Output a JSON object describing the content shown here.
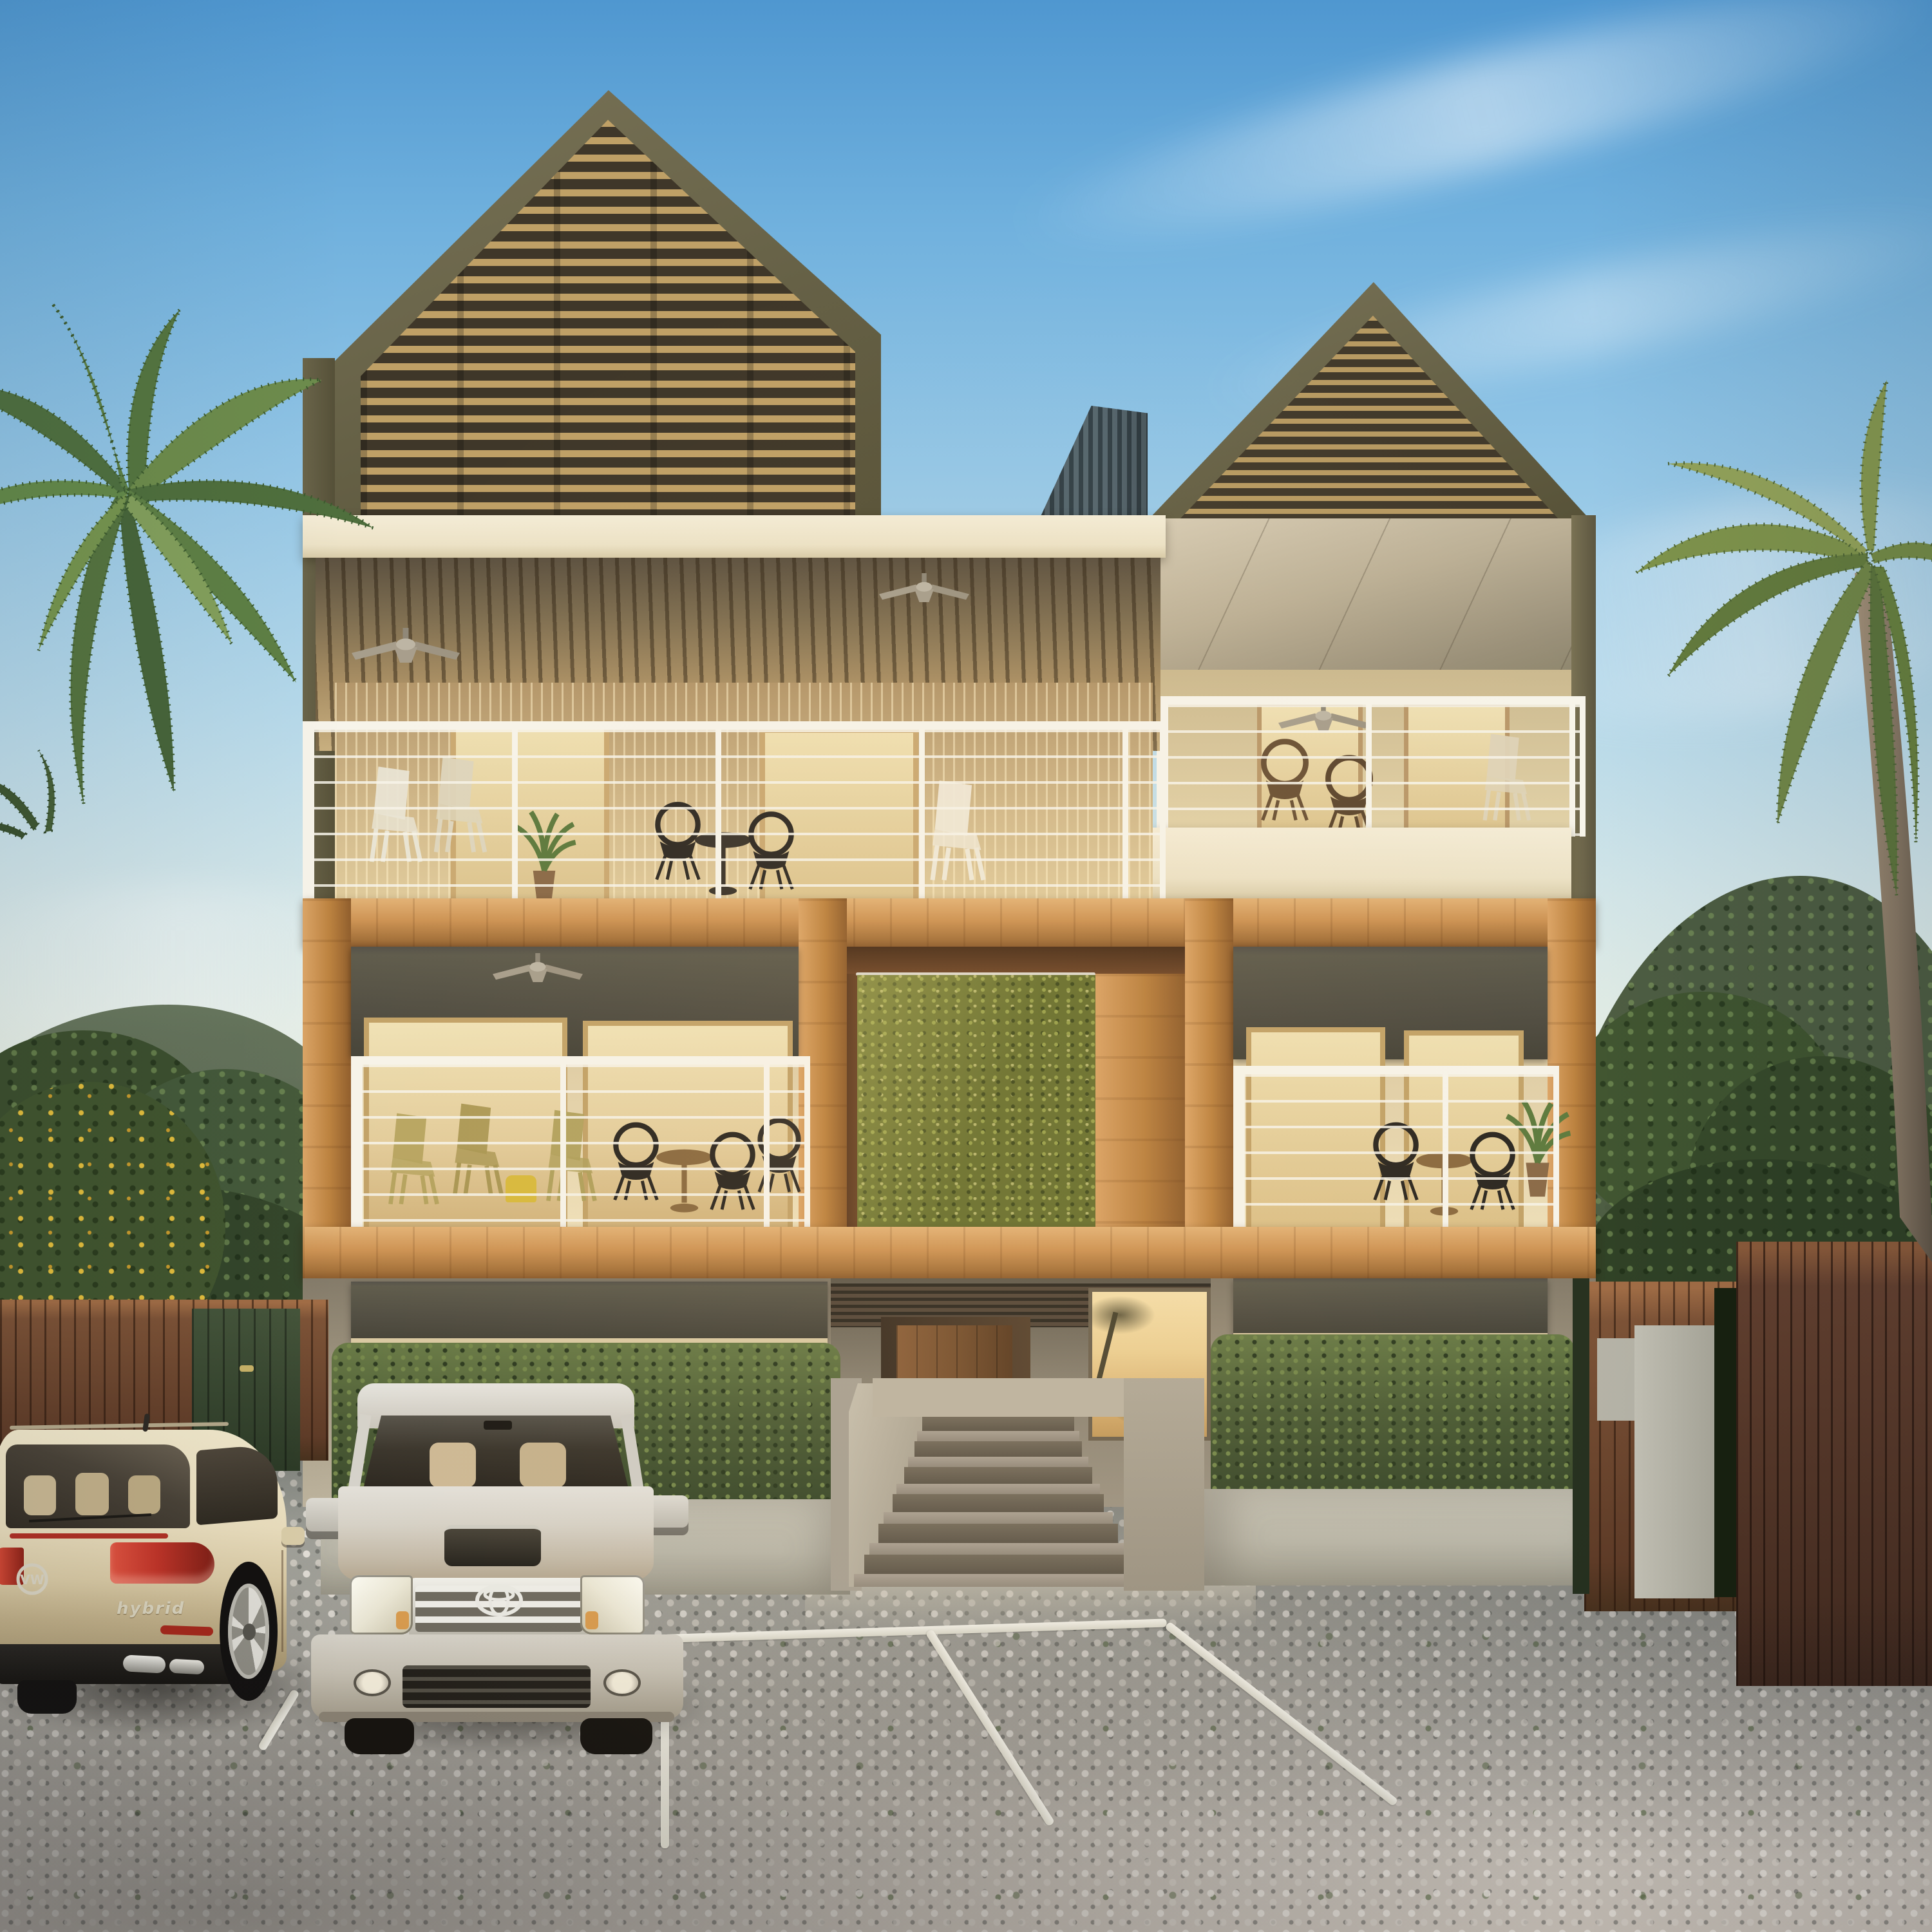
{
  "scene": {
    "description": "Photorealistic 3D architectural rendering of a modern tropical apartment building at dusk with louvered gable roofs, timber balconies, a living green wall, hedges, palm trees, forested hills and a paver parking lot with two parked vehicles",
    "time_of_day": "dusk"
  },
  "palette": {
    "sky_top": "#4f97d0",
    "sky_horizon": "#f1f2e6",
    "gable_frame": "#6a654a",
    "louver_light": "#bfa066",
    "louver_dark": "#3f3729",
    "corrugated_metal": "#44545c",
    "fascia_cream": "#f0e8d0",
    "soffit_wood": "#a98f64",
    "wall_cream": "#ddc9a0",
    "railing_white": "#f7f4ea",
    "timber": "#c08848",
    "awning_grey": "#54514a",
    "green_wall": "#67702f",
    "hedge_green": "#4e5e37",
    "ground_wall": "#a79d8a",
    "door_wood": "#75502f",
    "planter_grey": "#bdbaac",
    "pavement": "#adaca4",
    "parking_line": "#f1efe6",
    "fence_left": "#7c5236",
    "fence_right": "#63402f",
    "gate_green": "#36452f",
    "hill_green": "#4c5c42",
    "palm_green": "#6a8a4e",
    "palm_trunk": "#8d7c66",
    "vw_paint": "#e8dcba",
    "taillight_red": "#c0392b",
    "hilux_silver": "#d3d0c8",
    "glass_warm": "#ecd094",
    "shadow": "#3c3831"
  },
  "building": {
    "floors_visible": 3,
    "towers": [
      {
        "name": "left-louvered-gable",
        "shape": "pentagon",
        "louver_rows": 25
      },
      {
        "name": "right-louvered-gable",
        "shape": "triangle",
        "louver_rows": 14
      }
    ],
    "railing_cable_rows": 7,
    "balconies": [
      "third-floor-left",
      "third-floor-right",
      "second-floor-left",
      "second-floor-right"
    ],
    "green_wall_present": true,
    "ceiling_fans": 5
  },
  "entrance": {
    "steps": 6,
    "door_type": "single wood door",
    "ramp": true
  },
  "parking": {
    "stall_lines": 5,
    "surface": "grass-joint cobble pavers",
    "occupied_stalls": 2,
    "empty_stalls": 2
  },
  "vehicles": [
    {
      "name": "vw-suv",
      "color": "cream",
      "badge": "VW",
      "trim_badge": "hybrid",
      "view": "rear-three-quarter"
    },
    {
      "name": "toyota-hilux-pickup",
      "color": "silver",
      "badge": "TOYOTA",
      "view": "front"
    }
  ],
  "vegetation": {
    "palm_trees": 2,
    "hedges": 2,
    "flowering_bush_color": "yellow",
    "hills": "forested"
  }
}
